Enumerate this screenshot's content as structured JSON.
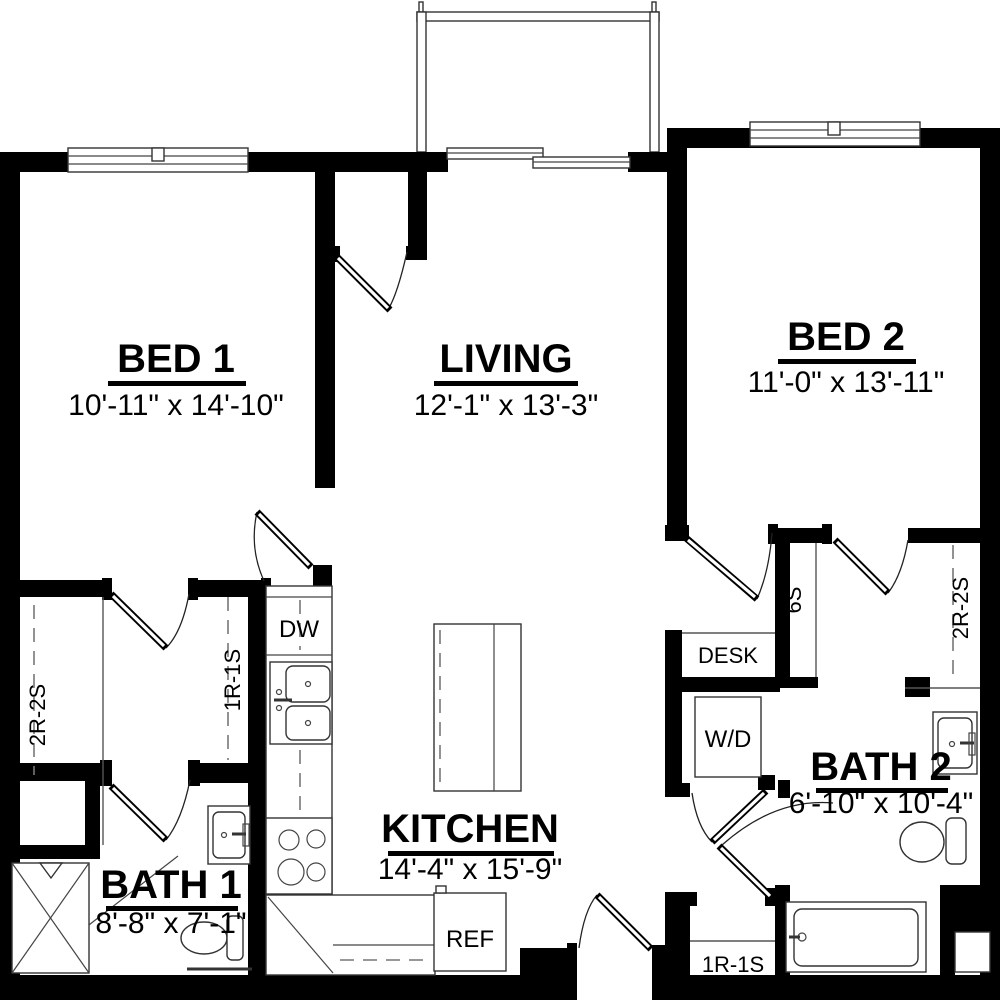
{
  "plan": {
    "rooms": [
      {
        "key": "bed1",
        "name": "BED 1",
        "dims": "10'-11\" x 14'-10\""
      },
      {
        "key": "living",
        "name": "LIVING",
        "dims": "12'-1\" x 13'-3\""
      },
      {
        "key": "bed2",
        "name": "BED 2",
        "dims": "11'-0\" x 13'-11\""
      },
      {
        "key": "kitchen",
        "name": "KITCHEN",
        "dims": "14'-4\" x 15'-9\""
      },
      {
        "key": "bath1",
        "name": "BATH 1",
        "dims": "8'-8\" x 7'-1\""
      },
      {
        "key": "bath2",
        "name": "BATH 2",
        "dims": "6'-10\" x 10'-4\""
      }
    ],
    "appliances": {
      "dishwasher": "DW",
      "refrigerator": "REF",
      "washer_dryer": "W/D",
      "desk": "DESK"
    },
    "stairs": {
      "closet_left": "2R-2S",
      "hall_left": "1R-1S",
      "stair_mid": "6S",
      "closet_right": "2R-2S",
      "entry_landing": "1R-1S"
    },
    "colors": {
      "wall": "#000000",
      "fixture_line": "#333333",
      "dash_line": "#777777",
      "background": "#ffffff"
    }
  }
}
